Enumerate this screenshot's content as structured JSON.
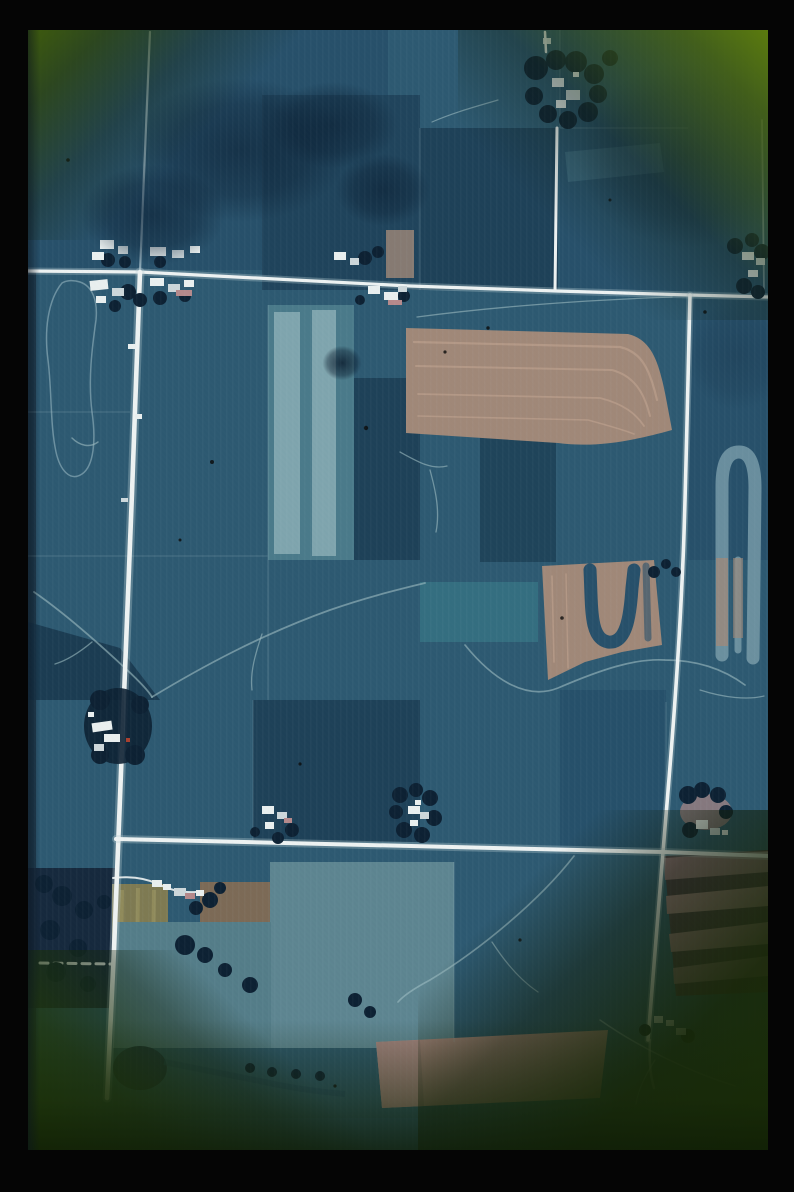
{
  "scene": {
    "type": "aerial-photograph-slide",
    "medium": "color film slide in a black mount",
    "subject": "rural farmland seen from above: grid of rectangular crop fields, white gravel section roads, farmsteads with tree windbreaks, drainage streams, a pond and cloud shadows",
    "vignette": "circular image area fading to olive-green slide-mount corners",
    "contains_text": "none"
  },
  "palette": {
    "frame_black": "#050505",
    "field_teal": "#2d5971",
    "field_teal2": "#27506a",
    "field_teal_light": "#39707f",
    "field_navy": "#1e4158",
    "field_navy_dark": "#17344b",
    "strip_light": "#7fa5ae",
    "field_light_a": "#5d8591",
    "field_light_b": "#547d89",
    "field_tan": "#a08878",
    "tan_light": "#c2a691",
    "field_pink": "#b18c85",
    "field_maroon": "#453642",
    "band_pink": "#9d7b80",
    "field_yellow": "#7e7a52",
    "field_brown": "#7c6a56",
    "tree_dark": "#0d2133",
    "pond_dark": "#1b3347",
    "road_white": "#edf2f2",
    "road_glow": "#b9cdd4",
    "road_faint": "#a3bac6",
    "stream_light": "#9dbcc2",
    "terrace_light": "#7b9dab",
    "boundary_line": "#a8c4cc",
    "building_white": "#e9efef",
    "building_gray": "#cdd7da",
    "roof_pink": "#b5898b",
    "red_speck": "#a8402f",
    "speck_dark": "#0a0a0a",
    "corner_green_tl": "#3e5b0d",
    "corner_green_tr": "#5b7b0e",
    "corner_green_bl": "#223d06",
    "corner_green_br": "#1b3006"
  },
  "features": {
    "roads": {
      "horizontal_section_roads": 2,
      "vertical_section_roads": 3,
      "dashed_partial_road_lower_left": 1,
      "road_intersections": 4
    },
    "farmstead_clusters": 10,
    "pond_count": 1,
    "tan_contour_fields": 2,
    "striped_fields": 3,
    "forest_patches": 1,
    "cloud_shadow_patches": 7,
    "stream_channels": "branching drainage network, center-left and bottom"
  }
}
